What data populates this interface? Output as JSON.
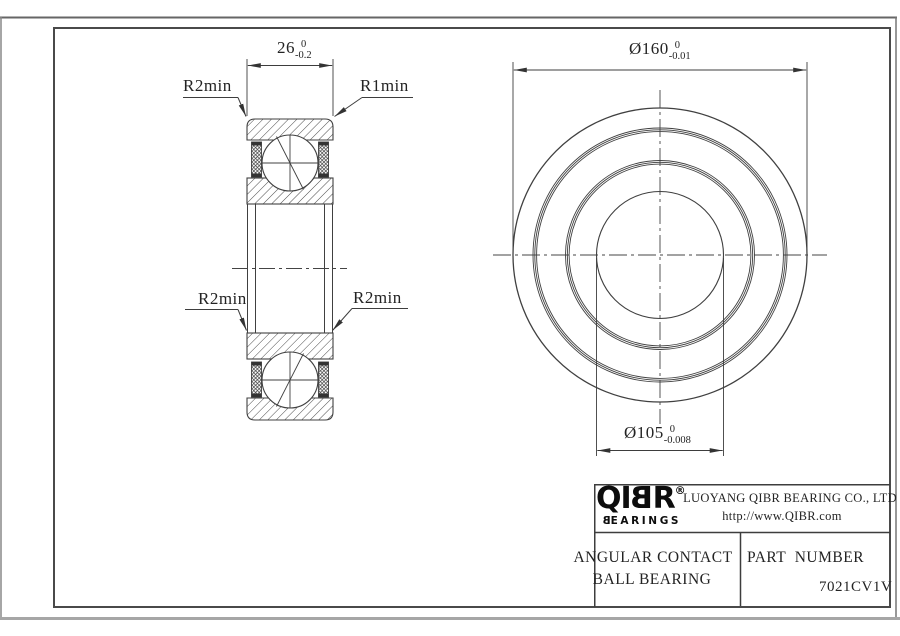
{
  "drawing": {
    "section_view": {
      "width_dim": {
        "value": "26",
        "tol_upper": "0",
        "tol_lower": "-0.2"
      },
      "labels": {
        "top_left": "R2min",
        "top_right": "R1min",
        "bottom_left": "R2min",
        "bottom_right": "R2min"
      }
    },
    "front_view": {
      "outer_dia_dim": {
        "value": "Ø160",
        "tol_upper": "0",
        "tol_lower": "-0.01"
      },
      "bore_dia_dim": {
        "value": "Ø105",
        "tol_upper": "0",
        "tol_lower": "-0.008"
      }
    }
  },
  "title_block": {
    "logo": {
      "char_q": "Q",
      "char_i": "I",
      "char_b": "B",
      "char_r": "R",
      "registered": "®",
      "sub_first": "B",
      "sub_rest": "EARINGS"
    },
    "company": "LUOYANG QIBR BEARING CO., LTD",
    "website": "http://www.QIBR.com",
    "product_name_line1": "ANGULAR CONTACT",
    "product_name_line2": "BALL BEARING",
    "part_number_label": "PART  NUMBER",
    "part_number_value": "7021CV1V"
  },
  "colors": {
    "line": "#404040",
    "hatch": "#4a4a4a",
    "text": "#232323",
    "frame": "#4a4a4a",
    "page_edge_dark": "#666666",
    "page_edge_gray": "#a6a6a6",
    "background": "#ffffff"
  }
}
